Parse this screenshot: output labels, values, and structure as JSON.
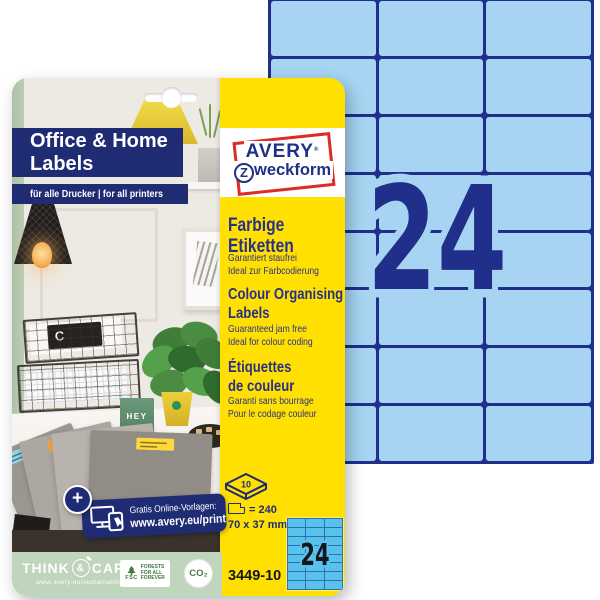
{
  "colors": {
    "package_yellow": "#FFE000",
    "banner_navy": "#1F2C74",
    "sheet_fill_blue": "#A6D4F2",
    "sheet_grid_navy": "#20308A",
    "mini_sheet_fill": "#58C1EC",
    "mini_sheet_grid": "#2E6FB2",
    "logo_red": "#DD2B26",
    "sustainability_green": "#BFD5BC"
  },
  "header": {
    "title_line1": "Office & Home",
    "title_line2": "Labels",
    "subtitle": "für alle Drucker | for all printers"
  },
  "brand": {
    "name_line1": "AVERY",
    "registered_mark": "®",
    "name_line2_initial": "Z",
    "name_line2_rest": "weckform"
  },
  "sections": {
    "de": {
      "title_line1": "Farbige",
      "title_line2": "Etiketten",
      "feature_line1": "Garantiert staufrei",
      "feature_line2": "Ideal zur Farbcodierung"
    },
    "en": {
      "title_line1": "Colour Organising",
      "title_line2": "Labels",
      "feature_line1": "Guaranteed jam free",
      "feature_line2": "Ideal for colour coding"
    },
    "fr": {
      "title_line1": "Étiquettes",
      "title_line2": "de couleur",
      "feature_line1": "Garanti sans bourrage",
      "feature_line2": "Pour le codage couleur"
    }
  },
  "specs": {
    "sheet_count": "10",
    "labels_per_pack": "= 240",
    "label_size": "70 x 37 mm",
    "sku": "3449-10"
  },
  "promo": {
    "plus": "+",
    "line1": "Gratis Online-Vorlagen:",
    "line2": "www.avery.eu/print"
  },
  "sustainability": {
    "think": "THINK",
    "amp": "&",
    "care": "CARE",
    "url": "www.avery.eu/sustainability",
    "fsc_acronym": "FSC",
    "fsc_tagline": "FORESTS FOR ALL FOREVER",
    "co2_label": "CO₂"
  },
  "big_sheet": {
    "count_label": "24",
    "rows": 8,
    "columns": 3
  },
  "mini_sheet": {
    "count_label": "24",
    "rows": 8,
    "columns": 3
  },
  "photo": {
    "mug_text": "HEY",
    "book_letter": "C",
    "folder_tabs": [
      {
        "color": "#8FD4E8"
      },
      {
        "color": "#FFA23E"
      },
      {
        "color": "#97C83C"
      },
      {
        "color": "#FFD83B"
      }
    ]
  }
}
